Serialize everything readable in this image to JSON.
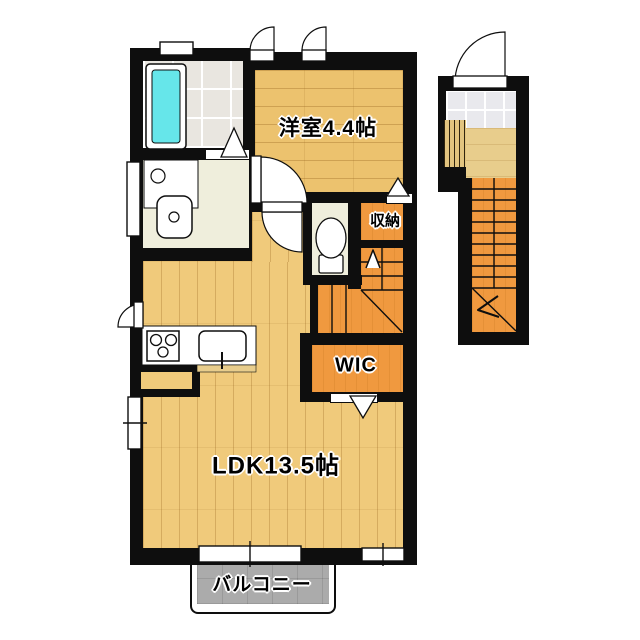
{
  "plan": {
    "type": "japanese-apartment-floor-plan",
    "rooms": [
      {
        "id": "western_room",
        "label": "洋室4.4帖"
      },
      {
        "id": "ldk",
        "label": "LDK13.5帖"
      },
      {
        "id": "wic",
        "label": "WIC"
      },
      {
        "id": "storage",
        "label": "収納"
      },
      {
        "id": "balcony",
        "label": "バルコニー"
      }
    ],
    "fixtures": [
      "bathtub",
      "washing-machine-pan",
      "vanity-sink",
      "toilet",
      "kitchen-stove",
      "kitchen-sink"
    ],
    "stairs": [
      "internal-staircase-up",
      "external-entrance-staircase"
    ],
    "colors": {
      "wall": "#0e0e0e",
      "wood_a": "#ecc26e",
      "wood_b": "#f0ca7b",
      "wood_landing": "#e8cd8c",
      "orange": "#f0993f",
      "bath_tile": "#e9e6e0",
      "pale": "#efeedc",
      "entry_tile": "#e9e9ed",
      "balcony": "#ababab",
      "tub": "#66e6ea",
      "background": "#ffffff"
    }
  }
}
